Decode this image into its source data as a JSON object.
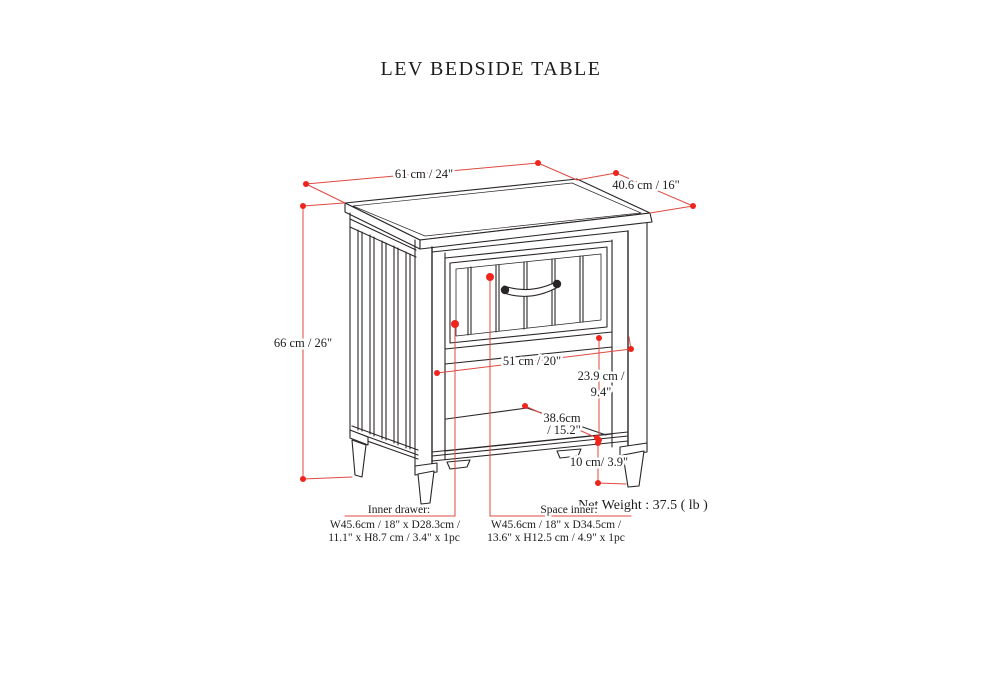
{
  "title": "LEV BEDSIDE TABLE",
  "dimensions": {
    "top_width": "61 cm / 24\"",
    "top_depth": "40.6 cm / 16\"",
    "overall_height": "66 cm / 26\"",
    "opening_width": "51 cm / 20\"",
    "opening_height_l1": "23.9 cm /",
    "opening_height_l2": "9.4\"",
    "shelf_depth_l1": "38.6cm",
    "shelf_depth_l2": "/ 15.2\"",
    "leg_height": "10 cm/ 3.9\""
  },
  "net_weight": "Net Weight : 37.5 ( lb )",
  "annotations": {
    "inner_drawer": {
      "label": "Inner drawer:",
      "line1": "W45.6cm / 18\" x D28.3cm /",
      "line2": "11.1\" x H8.7 cm / 3.4\" x 1pc"
    },
    "space_inner": {
      "label": "Space inner:",
      "line1": "W45.6cm / 18\" x D34.5cm /",
      "line2": "13.6\" x H12.5 cm / 4.9\" x 1pc"
    }
  },
  "colors": {
    "line_art": "#2a2627",
    "dimension_line": "#df4a42",
    "marker_dot": "#ee241d",
    "background": "#ffffff"
  }
}
